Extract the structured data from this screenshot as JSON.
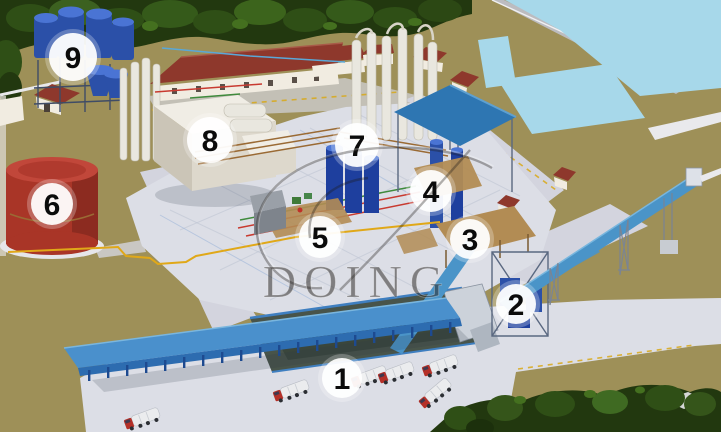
{
  "watermark": {
    "text": "DOING"
  },
  "markers": [
    {
      "label": "1",
      "transform": "translate(342,378)",
      "r": "20"
    },
    {
      "label": "2",
      "transform": "translate(516,304)",
      "r": "20"
    },
    {
      "label": "3",
      "transform": "translate(470,239)",
      "r": "20"
    },
    {
      "label": "4",
      "transform": "translate(431,191)",
      "r": "21"
    },
    {
      "label": "5",
      "transform": "translate(320,237)",
      "r": "21"
    },
    {
      "label": "6",
      "transform": "translate(52,204)",
      "r": "21"
    },
    {
      "label": "7",
      "transform": "translate(357,145)",
      "r": "22"
    },
    {
      "label": "8",
      "transform": "translate(210,140)",
      "r": "23"
    },
    {
      "label": "9",
      "transform": "translate(73,57)",
      "r": "24"
    }
  ],
  "colors": {
    "ground": "#9e9058",
    "treeDark": "#22380f",
    "treeMid": "#2f4f16",
    "pond": "#a7d8ea",
    "concrete": "#dcdee6",
    "road": "#d3d4de",
    "roofRed": "#8e382c",
    "buildingWall": "#f1ece1",
    "tankBlue": "#2b50a8",
    "tankRed": "#a93527",
    "canopyBlue": "#4a90cc",
    "conveyorBlue": "#4a94c8",
    "steelCanopy": "#2e76b2",
    "platformTan": "#b28c54",
    "pipelineYellow": "#e0a818",
    "truckRed": "#b53028",
    "markerBg": "rgba(255,255,255,0.93)",
    "markerText": "#0b0b0b",
    "watermarkInk": "rgba(42,38,34,0.52)"
  }
}
